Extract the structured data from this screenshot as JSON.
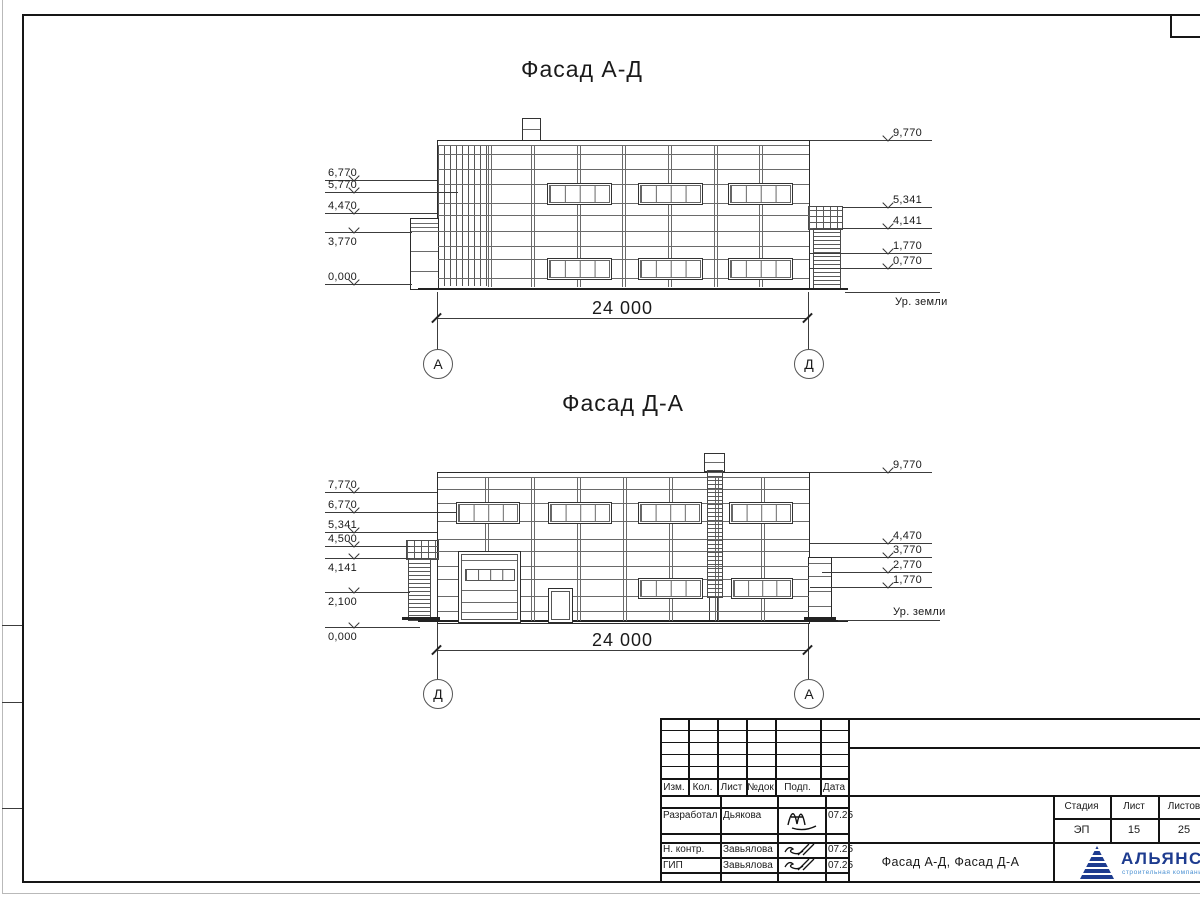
{
  "f1": {
    "title": "Фасад А-Д",
    "dim": "24 000",
    "marker_left": "А",
    "marker_right": "Д",
    "ground": "Ур. земли",
    "left": [
      "6,770",
      "5,770",
      "4,470",
      "3,770",
      "0,000"
    ],
    "right": [
      "9,770",
      "5,341",
      "4,141",
      "1,770",
      "0,770"
    ]
  },
  "f2": {
    "title": "Фасад Д-А",
    "dim": "24 000",
    "marker_left": "Д",
    "marker_right": "А",
    "ground": "Ур. земли",
    "left": [
      "7,770",
      "6,770",
      "5,341",
      "4,500",
      "4,141",
      "2,100",
      "0,000"
    ],
    "right": [
      "9,770",
      "4,470",
      "3,770",
      "2,770",
      "1,770"
    ]
  },
  "titleblock": {
    "rev_headers": [
      "Изм.",
      "Кол.",
      "Лист",
      "№док",
      "Подп.",
      "Дата"
    ],
    "sign_rows": [
      {
        "role": "Разработал",
        "name": "Дьякова",
        "date": "07.25"
      },
      {
        "role": "Н. контр.",
        "name": "Завьялова",
        "date": "07.25"
      },
      {
        "role": "ГИП",
        "name": "Завьялова",
        "date": "07.25"
      }
    ],
    "doc_title": "Фасад А-Д, Фасад Д-А",
    "stage_label": "Стадия",
    "sheet_label": "Лист",
    "sheets_label": "Листов",
    "stage": "ЭП",
    "sheet": "15",
    "sheets": "25",
    "logo_text": "АЛЬЯНС",
    "logo_sub": "строительная компания",
    "logo_color": "#1d3b8f",
    "logo_sub_color": "#4a90d2"
  }
}
